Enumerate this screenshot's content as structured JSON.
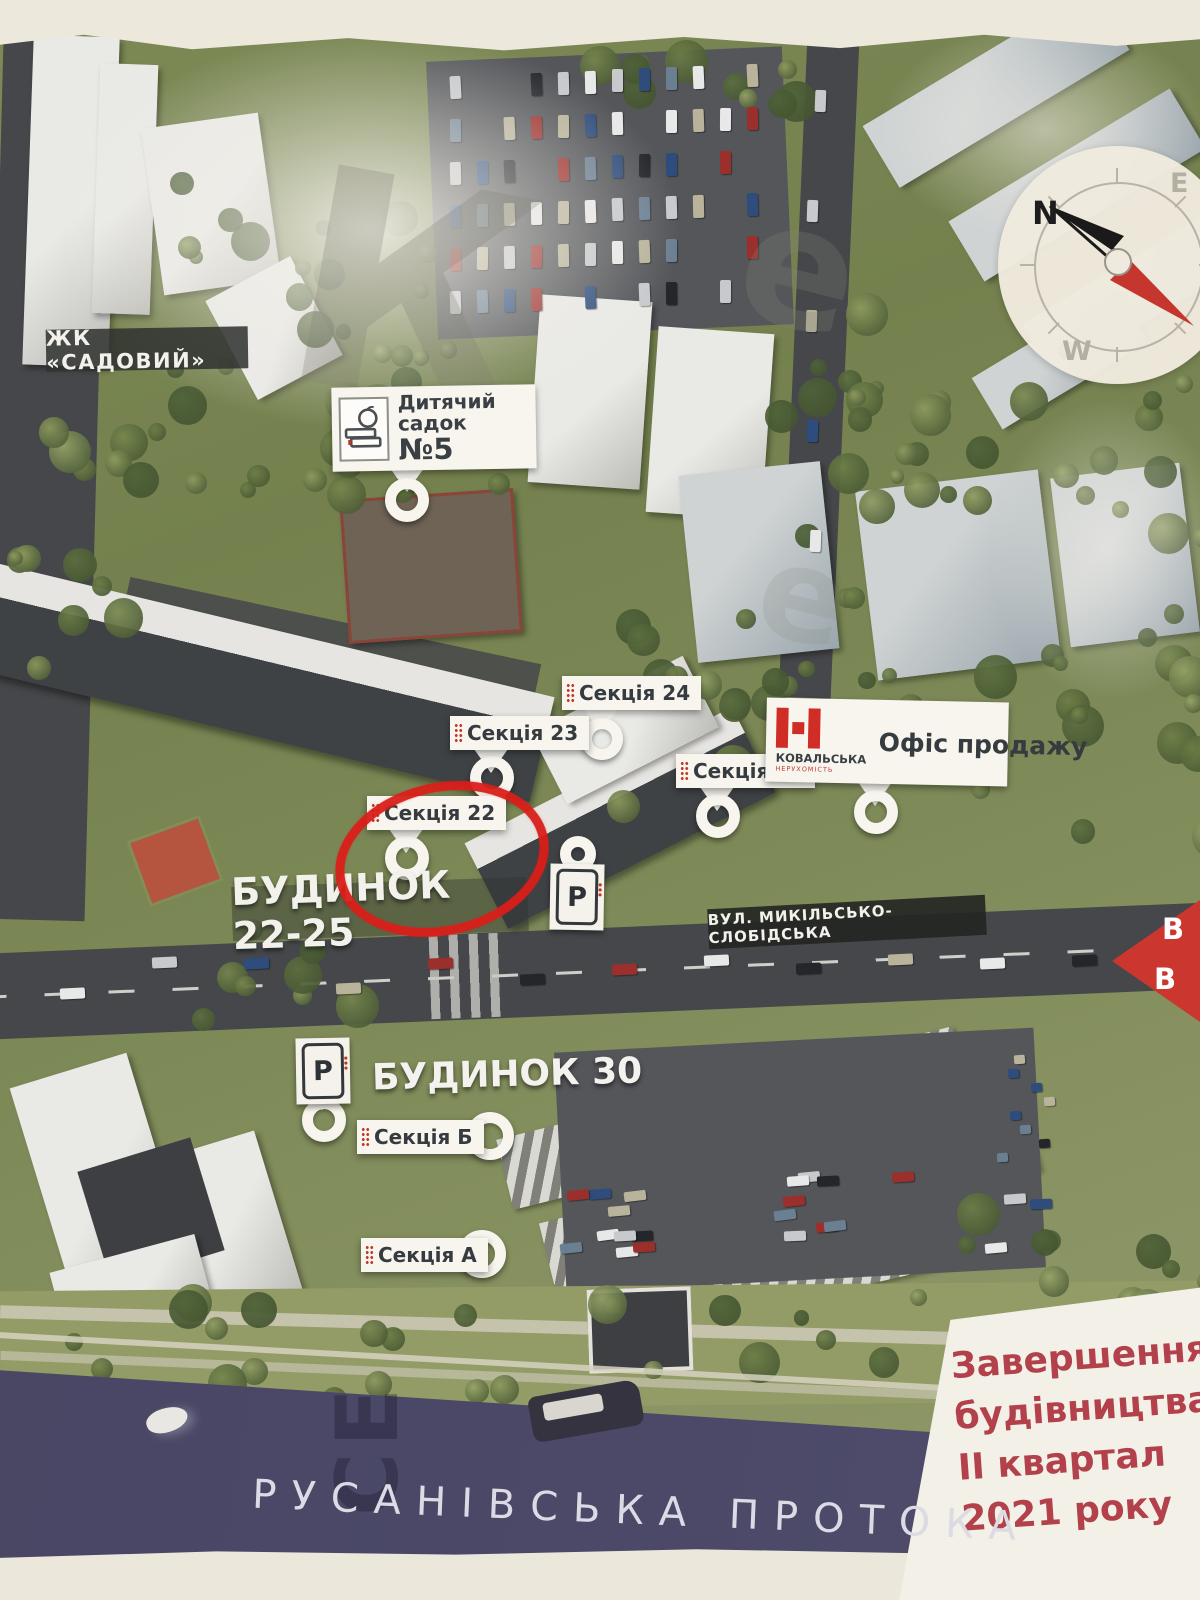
{
  "labels": {
    "complex": "ЖК «САДОВИЙ»",
    "kindergarten_title": "Дитячий садок",
    "kindergarten_number": "№5",
    "section_24": "Секція 24",
    "section_23": "Секція 23",
    "section_25": "Секція 25",
    "section_22": "Секція 22",
    "section_b": "Секція Б",
    "section_a": "Секція А",
    "building_22_25": "БУДИНОК 22-25",
    "building_30": "БУДИНОК 30",
    "street": "ВУЛ. МИКІЛЬСЬКО-СЛОБІДСЬКА",
    "sales_office": "Офіс продажу",
    "brand_name": "КОВАЛЬСЬКА",
    "brand_sub": "НЕРУХОМІСТЬ",
    "waterway": "РУСАНІВСЬКА ПРОТОКА",
    "parking": "P"
  },
  "compass": {
    "north": "N",
    "east": "E",
    "west": "W",
    "south": "S"
  },
  "completion_note": {
    "line1": "Завершення",
    "line2": "будівництва",
    "line3": "ІІ квартал",
    "line4": "2021 року"
  },
  "exit_arrow": {
    "line1": "В",
    "line2": "В"
  },
  "watermarks": {
    "big_k": "К",
    "small_e": "е",
    "water_text": "СЕ"
  },
  "colors": {
    "accent_red": "#cf2d26",
    "completion_red": "#b2414b",
    "water": "#4a4765",
    "paper": "#ece8dc",
    "label_dark": "#363b40"
  }
}
